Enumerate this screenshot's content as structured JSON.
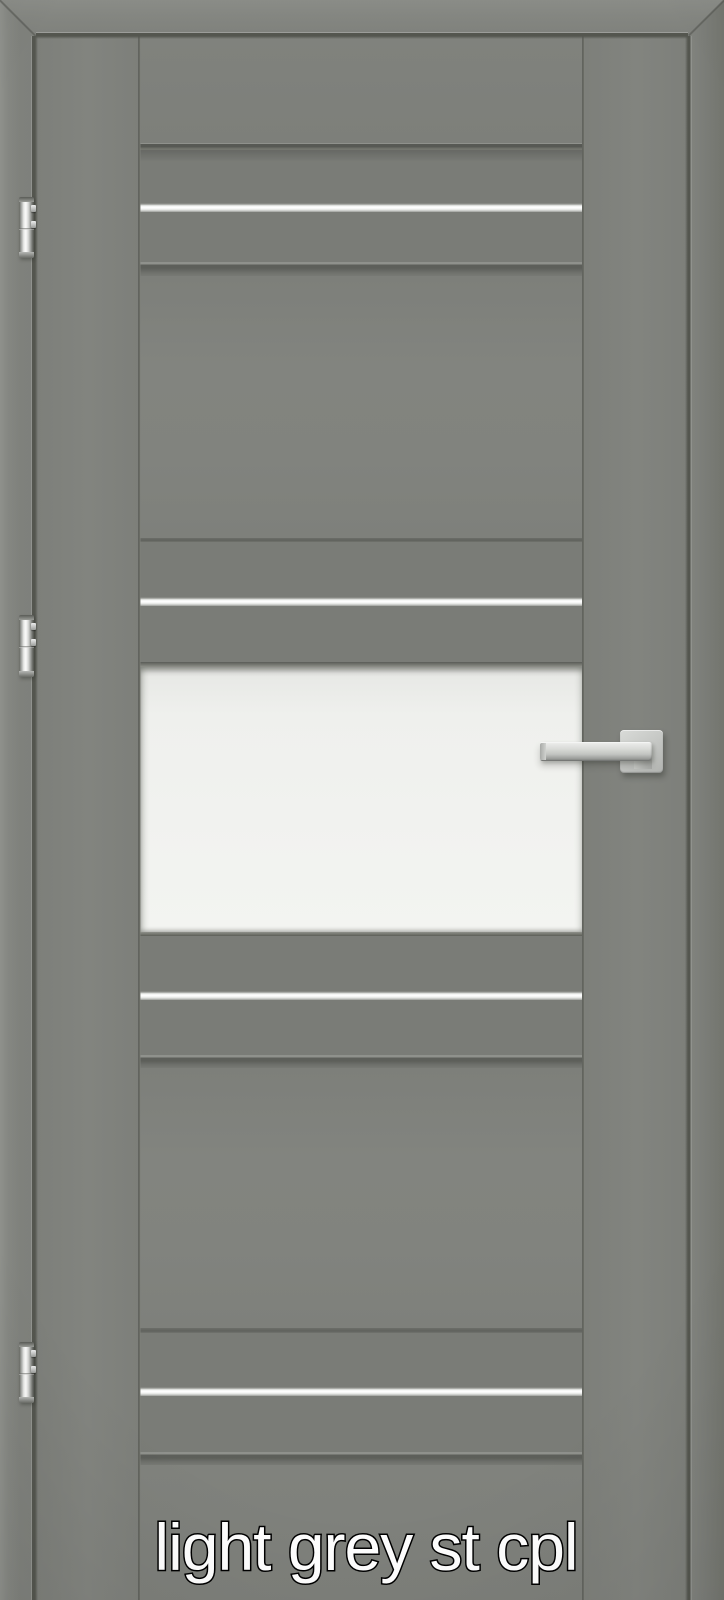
{
  "image": {
    "caption": "light grey st cpl"
  },
  "colors": {
    "door": "#7e807b",
    "band": "#7a7c77",
    "glass": "#f1f2ef",
    "metal": "#ffffff",
    "caption_fill": "#ffffff",
    "caption_stroke": "#000000"
  },
  "hardware": {
    "hinges": 3,
    "hinge_side": "left",
    "handle_side": "right",
    "aluminum_strips": 4,
    "glass_panels": 1
  }
}
